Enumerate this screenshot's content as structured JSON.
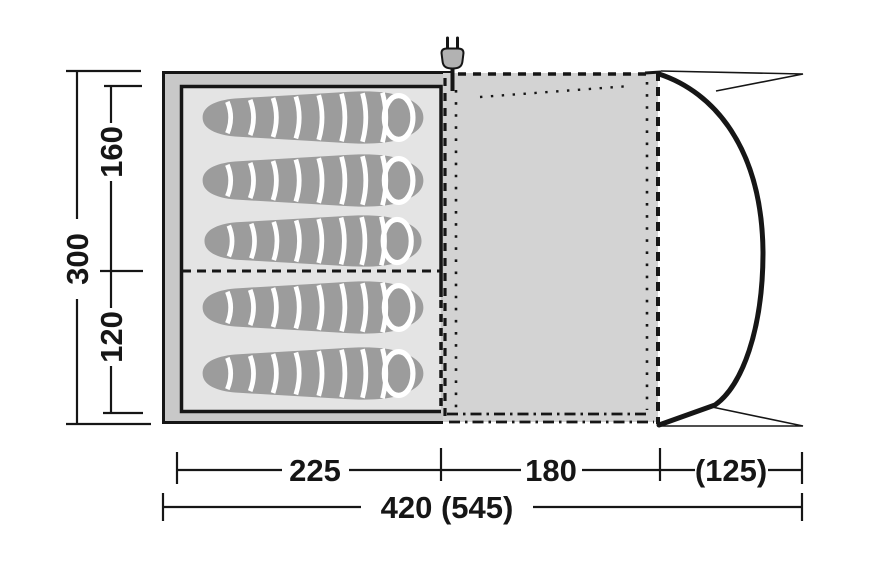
{
  "dims": {
    "left": {
      "total": "300",
      "cabin_top": "160",
      "cabin_bottom": "120"
    },
    "bottom": {
      "sleeping": "225",
      "living": "180",
      "canopy": "(125)",
      "total": "420 (545)"
    }
  },
  "icons": [
    {
      "id": "power-plug-icon"
    }
  ],
  "counts": {
    "sleeping_bags": 5
  },
  "colors": {
    "line": "#161616",
    "tent_body": "#c8c8c8",
    "living_floor": "#d3d3d3",
    "cabin_floor": "#e4e4e4",
    "sleeping_bag": "#9c9c9c",
    "stripe": "#ffffff",
    "plug_body": "#b2b2b2",
    "background": "#ffffff"
  }
}
